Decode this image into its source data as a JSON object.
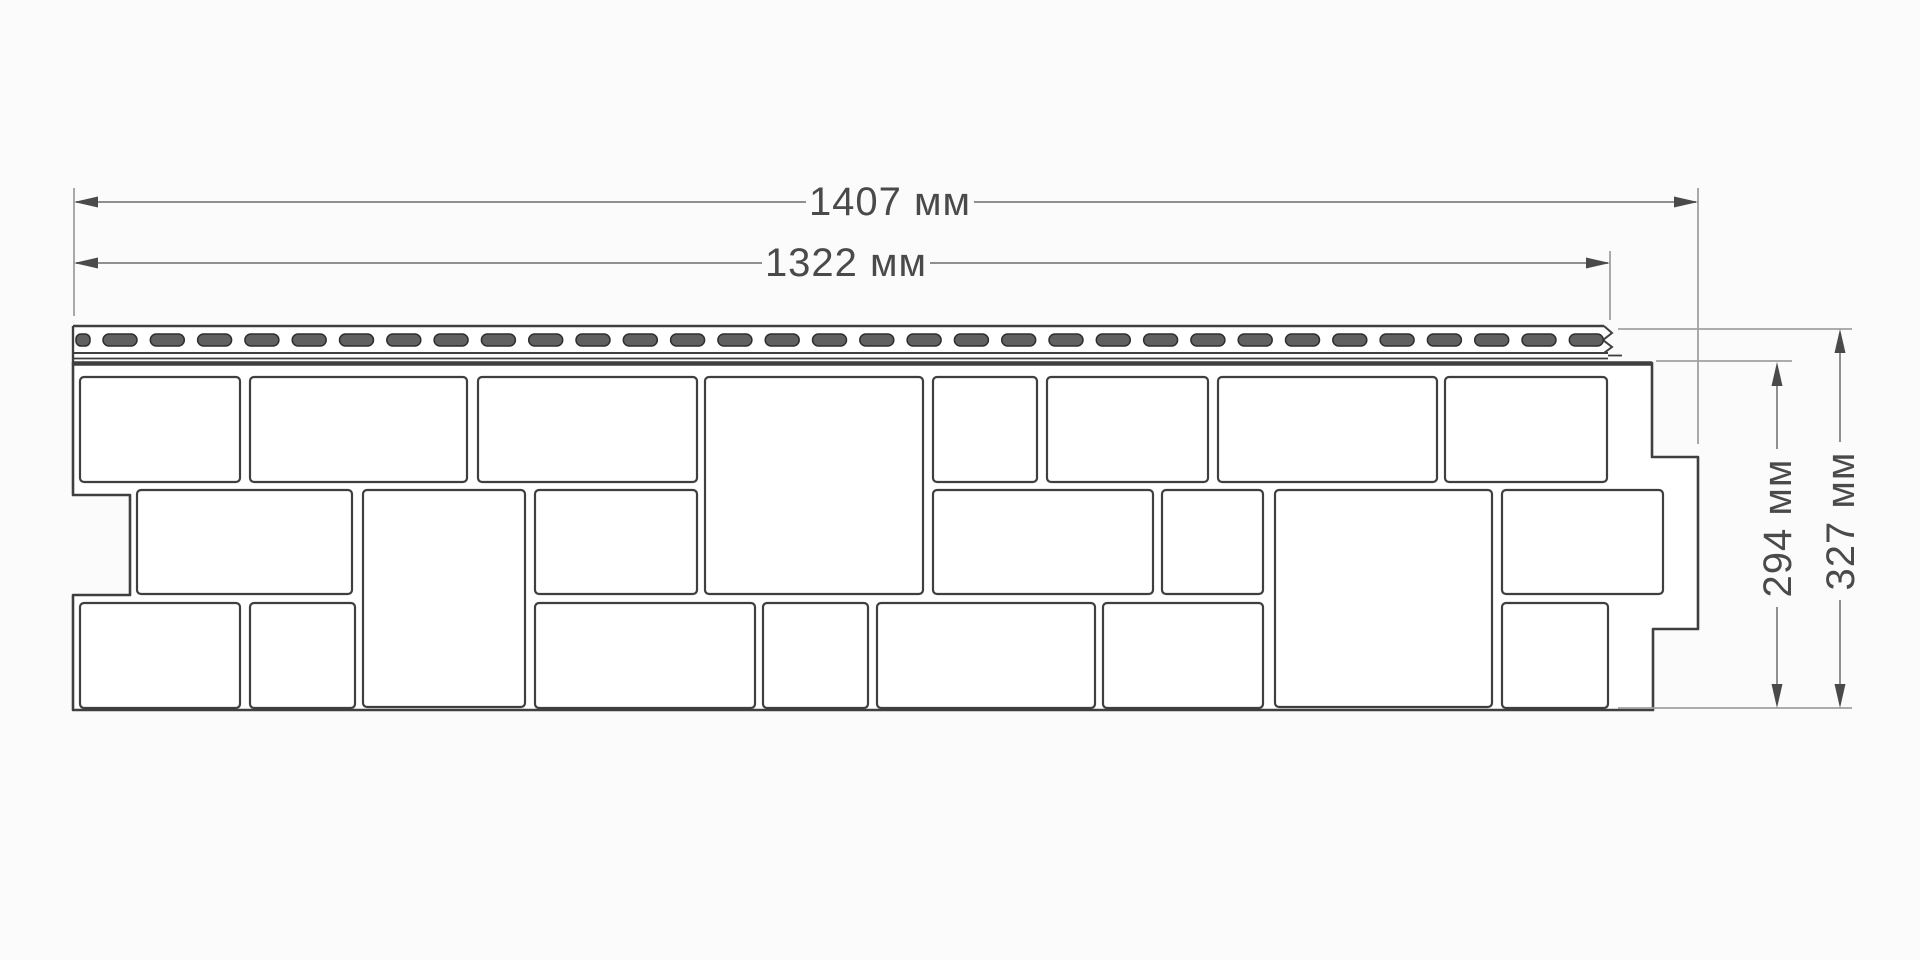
{
  "drawing": {
    "background": "#fbfbfb",
    "line_color": "#3f3f3f",
    "stone_fill": "#ffffff",
    "dim_line_color": "#8f8f8f",
    "ext_line_color": "#a0a0a0",
    "arrow_color": "#4a4a4a",
    "label_color": "#4a4a4a",
    "slot_fill": "#606060",
    "slot_stroke": "#2e2e2e"
  },
  "panel": {
    "outline": [
      [
        73,
        363
      ],
      [
        1652,
        363
      ],
      [
        1652,
        457
      ],
      [
        1698,
        457
      ],
      [
        1698,
        629
      ],
      [
        1653,
        629
      ],
      [
        1653,
        710
      ],
      [
        73,
        710
      ],
      [
        73,
        595
      ],
      [
        130,
        595
      ],
      [
        130,
        495
      ],
      [
        73,
        495
      ]
    ],
    "strip": {
      "x1": 73,
      "x2": 1604,
      "x2b": 1608,
      "band_x2": 1652,
      "top": 326,
      "bottom": 353,
      "line2": 358.5,
      "band": 363.5,
      "zigzag": [
        [
          1604,
          326
        ],
        [
          1612,
          333
        ],
        [
          1603,
          340
        ],
        [
          1612,
          347
        ],
        [
          1604,
          353
        ]
      ],
      "tab": {
        "x1": 1608,
        "x2": 1622,
        "y": 355.5
      },
      "slots": {
        "y": 334,
        "h": 12,
        "start": 103,
        "w": 34,
        "pitch": 47.3,
        "count": 32,
        "first_x": 76,
        "first_w": 14
      }
    },
    "stones": [
      [
        80,
        377,
        160,
        105
      ],
      [
        250,
        377,
        217,
        105
      ],
      [
        478,
        377,
        219,
        105
      ],
      [
        705,
        377,
        218,
        217
      ],
      [
        933,
        377,
        104,
        105
      ],
      [
        1047,
        377,
        161,
        105
      ],
      [
        1218,
        377,
        219,
        105
      ],
      [
        1445,
        377,
        162,
        105
      ],
      [
        137,
        490,
        215,
        104
      ],
      [
        363,
        490,
        162,
        217
      ],
      [
        535,
        490,
        162,
        104
      ],
      [
        933,
        490,
        220,
        104
      ],
      [
        1162,
        490,
        101,
        104
      ],
      [
        1275,
        490,
        217,
        217
      ],
      [
        1502,
        490,
        161,
        104
      ],
      [
        80,
        603,
        160,
        105
      ],
      [
        250,
        603,
        105,
        105
      ],
      [
        535,
        603,
        220,
        105
      ],
      [
        763,
        603,
        105,
        105
      ],
      [
        877,
        603,
        218,
        105
      ],
      [
        1103,
        603,
        160,
        105
      ],
      [
        1502,
        603,
        106,
        105
      ]
    ]
  },
  "dimensions": {
    "overall_width": {
      "label": "1407 мм",
      "value_mm": 1407,
      "y": 202,
      "x1": 74,
      "x2": 1698,
      "segments": [
        [
          76,
          806
        ],
        [
          974,
          1696
        ]
      ],
      "label_x": 890,
      "label_y": 202
    },
    "working_width": {
      "label": "1322 мм",
      "value_mm": 1322,
      "y": 263,
      "x1": 74,
      "x2": 1610,
      "segments": [
        [
          76,
          762
        ],
        [
          930,
          1608
        ]
      ],
      "label_x": 846,
      "label_y": 263
    },
    "working_height": {
      "label": "294 мм",
      "value_mm": 294,
      "x": 1777,
      "y1": 362,
      "y2": 708,
      "segments": [
        [
          366,
          449
        ],
        [
          607,
          704
        ]
      ],
      "label_x": 1778,
      "label_y": 528
    },
    "overall_height": {
      "label": "327 мм",
      "value_mm": 327,
      "x": 1840,
      "y1": 329,
      "y2": 708,
      "segments": [
        [
          333,
          442
        ],
        [
          600,
          704
        ]
      ],
      "label_x": 1841,
      "label_y": 521
    },
    "extension_lines": [
      {
        "x": 74,
        "y1": 188,
        "y2": 316
      },
      {
        "x": 1610,
        "y1": 251,
        "y2": 320
      },
      {
        "x": 1698,
        "y1": 188,
        "y2": 444
      }
    ],
    "reference_lines": [
      {
        "y": 329,
        "x1": 1618,
        "x2": 1852
      },
      {
        "y": 361,
        "x1": 1656,
        "x2": 1792
      },
      {
        "y": 708,
        "x1": 1618,
        "x2": 1852
      }
    ]
  }
}
